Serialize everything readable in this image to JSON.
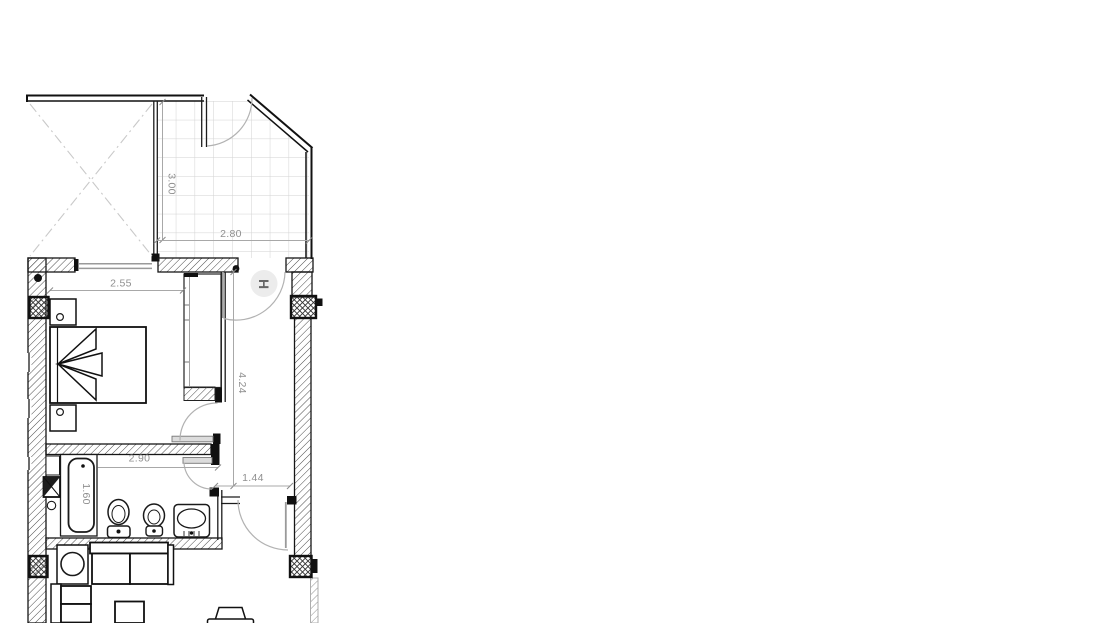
{
  "floor_plan": {
    "dimension_labels": {
      "terrace_depth": "3.00",
      "terrace_width": "2.80",
      "bedroom_width": "2.55",
      "hallway_length": "4.24",
      "hallway_width": "1.44",
      "bathroom_width": "2.90",
      "bathtub_length": "1.60"
    },
    "room_labels": {
      "hall": "H"
    },
    "colors": {
      "wall_line": "#161616",
      "dimension_text": "#8f8f8f",
      "tile_grid": "#d2d2d2",
      "door_arc": "#b2b2b2"
    }
  }
}
